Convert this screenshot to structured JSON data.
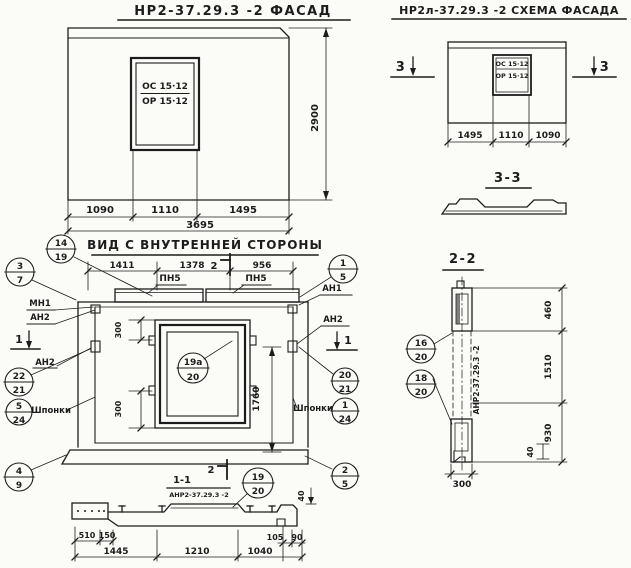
{
  "facade": {
    "title": "НР2-37.29.3 -2 ФАСАД",
    "window": {
      "top": "ОС 15·12",
      "bottom": "ОР 15·12"
    },
    "dims": {
      "w1": "1090",
      "w2": "1110",
      "w3": "1495",
      "total": "3695",
      "height": "2900"
    }
  },
  "scheme": {
    "title": "НР2л-37.29.3 -2 СХЕМА ФАСАДА",
    "window": {
      "top": "ОС 15·12",
      "bottom": "ОР 15·12"
    },
    "dims": {
      "w1": "1495",
      "w2": "1110",
      "w3": "1090"
    },
    "marker": "3"
  },
  "section33": {
    "title": "3-3"
  },
  "inner": {
    "title": "ВИД С ВНУТРЕННЕЙ СТОРОНЫ",
    "dims": {
      "t1": "1411",
      "t2": "1378",
      "t3": "956",
      "win_off_top": "300",
      "win_off_bot": "300",
      "height": "1760"
    },
    "labels": {
      "pn5a": "ПН5",
      "pn5b": "ПН5",
      "mn1": "МН1",
      "an2a": "АН2",
      "an2b": "АН2",
      "an1": "АН1",
      "an2c": "АН2",
      "shponki_left": "Шпонки",
      "shponki_right": "Шпонки"
    },
    "markers": {
      "m2": "2",
      "m1l": "1",
      "m1r": "1"
    },
    "callouts": {
      "c14_19": {
        "top": "14",
        "bottom": "19"
      },
      "c3_7": {
        "top": "3",
        "bottom": "7"
      },
      "c22_21": {
        "top": "22",
        "bottom": "21"
      },
      "c5_24": {
        "top": "5",
        "bottom": "24"
      },
      "c4_9": {
        "top": "4",
        "bottom": "9"
      },
      "c1_5": {
        "top": "1",
        "bottom": "5"
      },
      "c20_21": {
        "top": "20",
        "bottom": "21"
      },
      "c1_24": {
        "top": "1",
        "bottom": "24"
      },
      "c2_5": {
        "top": "2",
        "bottom": "5"
      },
      "c19a_20": {
        "top": "19а",
        "bottom": "20"
      }
    }
  },
  "section11": {
    "title": "1-1",
    "subtitle": "АНР2-37.29.3 -2",
    "marker": "2",
    "callout": {
      "top": "19",
      "bottom": "20"
    },
    "dims": {
      "d510": "510",
      "d150": "150",
      "d1445": "1445",
      "d1210": "1210",
      "d1040": "1040",
      "d105": "105",
      "d90": "90",
      "d40": "40"
    }
  },
  "section22": {
    "title": "2-2",
    "axis_label": "АНР2-37.29.3 -2",
    "callouts": {
      "c16_20": {
        "top": "16",
        "bottom": "20"
      },
      "c18_20": {
        "top": "18",
        "bottom": "20"
      }
    },
    "dims": {
      "d460": "460",
      "d1510": "1510",
      "d930": "930",
      "d40": "40",
      "d300": "300"
    }
  }
}
